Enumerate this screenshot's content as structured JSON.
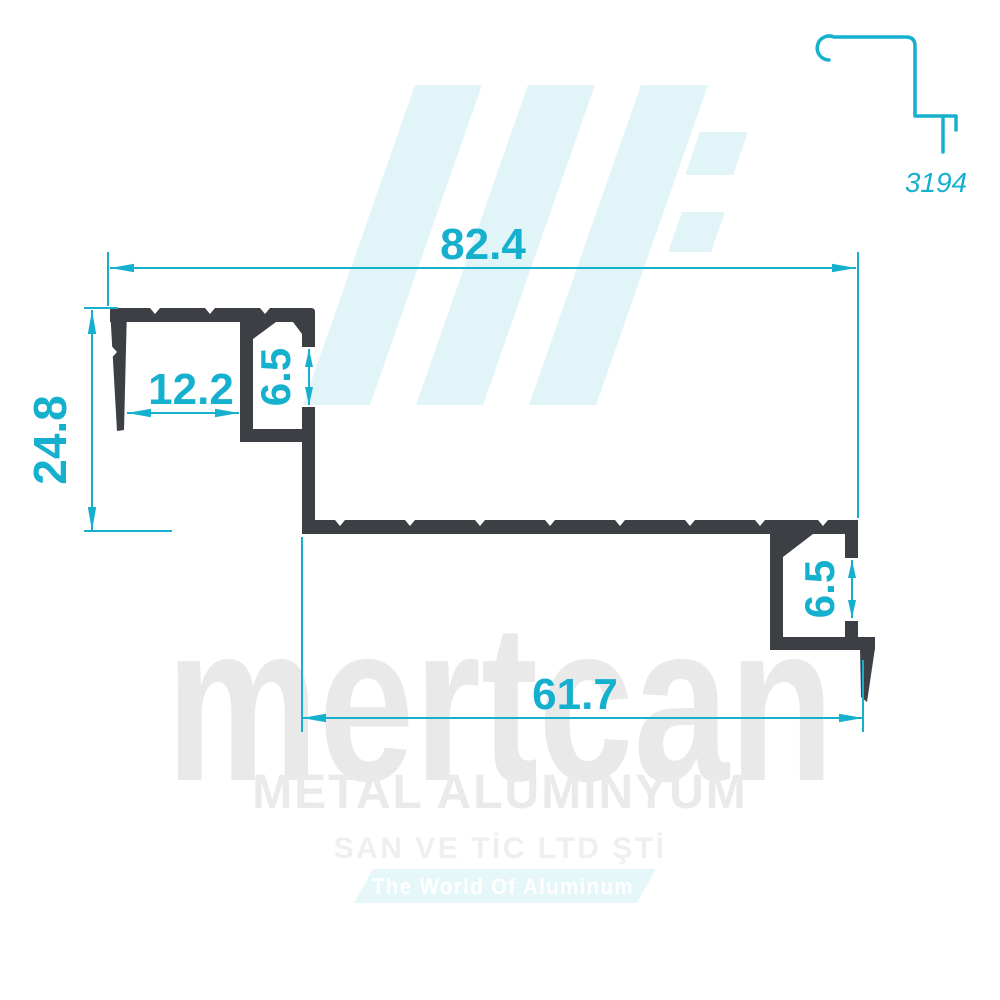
{
  "drawing": {
    "profile_number": "3194",
    "dimensions": {
      "overall_width": "82.4",
      "overall_height": "24.8",
      "front_channel_width": "12.2",
      "top_slot_height": "6.5",
      "bottom_slot_height": "6.5",
      "base_width": "61.7"
    },
    "colors": {
      "dimension_accent": "#16b0cf",
      "profile_body": "#3c3f43",
      "watermark_logo": "#e1f4f8",
      "watermark_text": "#e9e9e9"
    }
  },
  "watermark": {
    "brand": "mertcan",
    "line1": "METAL ALÜMİNYUM",
    "line2": "SAN VE TİC LTD ŞTİ",
    "banner": "The World Of Aluminum"
  }
}
